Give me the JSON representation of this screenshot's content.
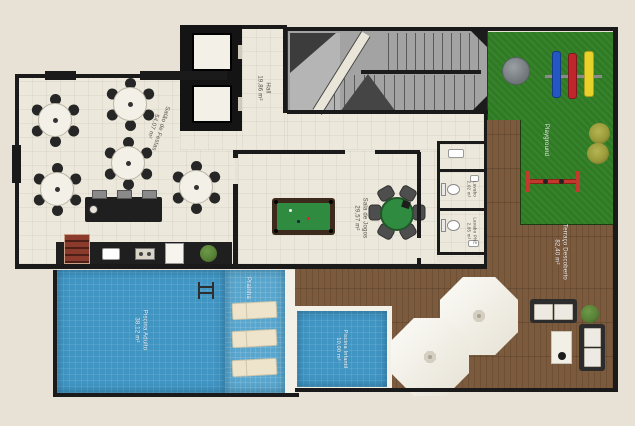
{
  "palette": {
    "bg": "#e7e2d5",
    "floor": "#ece8db",
    "wall": "#1a1a1a",
    "pool": "#4095c3",
    "pool-shallow": "#58a6cd",
    "deck": "#7b5a3e",
    "deck-dark": "#6e5035",
    "grass": "#2e7b23",
    "felt": "#2e8b3f",
    "stairs": "#a3a3a3",
    "white": "#f3f0e7",
    "counter": "#1f1f1f",
    "brick": "#8a3b2b",
    "swing-blue": "#2257c4",
    "swing-red": "#c0262c",
    "swing-yellow": "#e8d22a",
    "seesaw-red": "#c23a2e",
    "bush": "#567f35",
    "bush-olive": "#9a9a3a"
  },
  "rooms": {
    "salao": {
      "name": "Salão de Festas",
      "area": "54,07 m²"
    },
    "hall": {
      "name": "Hall",
      "area": "19,86 m²"
    },
    "sala_jogos": {
      "name": "Sala de Jogos",
      "area": "29,57 m²"
    },
    "lavabo": {
      "name": "Lavabo",
      "area": "2,02 m²"
    },
    "lavabo_pne": {
      "name": "Lavabo PNE",
      "area": "2,85 m²"
    },
    "playground": {
      "name": "Playground"
    },
    "terraco": {
      "name": "Terraço Descoberto",
      "area": "82,40 m²"
    },
    "piscina_adulto": {
      "name": "Piscina Adulto",
      "area": "38,12 m²"
    },
    "piscina_infantil": {
      "name": "Piscina Infantil",
      "area": "10,00 m²"
    },
    "prainha": {
      "name": "Prainha"
    }
  }
}
